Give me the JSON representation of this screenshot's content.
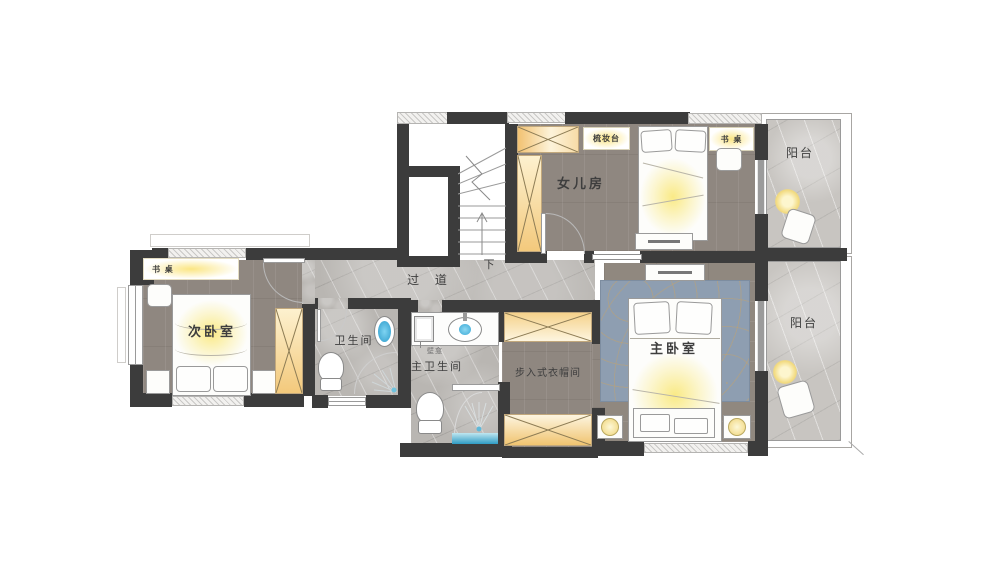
{
  "plan": {
    "type": "residential floor plan (second floor)",
    "colors": {
      "wall": "#3C3C3C",
      "wood_floor": "#8F8780",
      "marble_floor": "#B9B6B2",
      "balcony_marble": "#C8C5C1",
      "wardrobe_accent": "#F2C475",
      "warm_glow": "#F7E687",
      "rug_blue": "#8E9EB1",
      "basin_blue": "#3FB5E6",
      "shower_water": "#4FB3D6"
    },
    "rooms": {
      "daughter_room": {
        "label": "女儿房"
      },
      "balcony_top": {
        "label": "阳台"
      },
      "balcony_bottom": {
        "label": "阳台"
      },
      "secondary_bedroom": {
        "label": "次卧室"
      },
      "master_bedroom": {
        "label": "主卧室"
      },
      "bathroom": {
        "label": "卫生间"
      },
      "master_bathroom": {
        "label": "主卫生间"
      },
      "walk_in_closet": {
        "label": "步入式衣帽间"
      },
      "hallway": {
        "label": "过 道"
      }
    },
    "annotations": {
      "dressing_table": "梳妆台",
      "desk_daughter": "书 桌",
      "desk_secondary": "书 桌",
      "wall_niche": "壁龛",
      "stairs_down": "下"
    }
  }
}
